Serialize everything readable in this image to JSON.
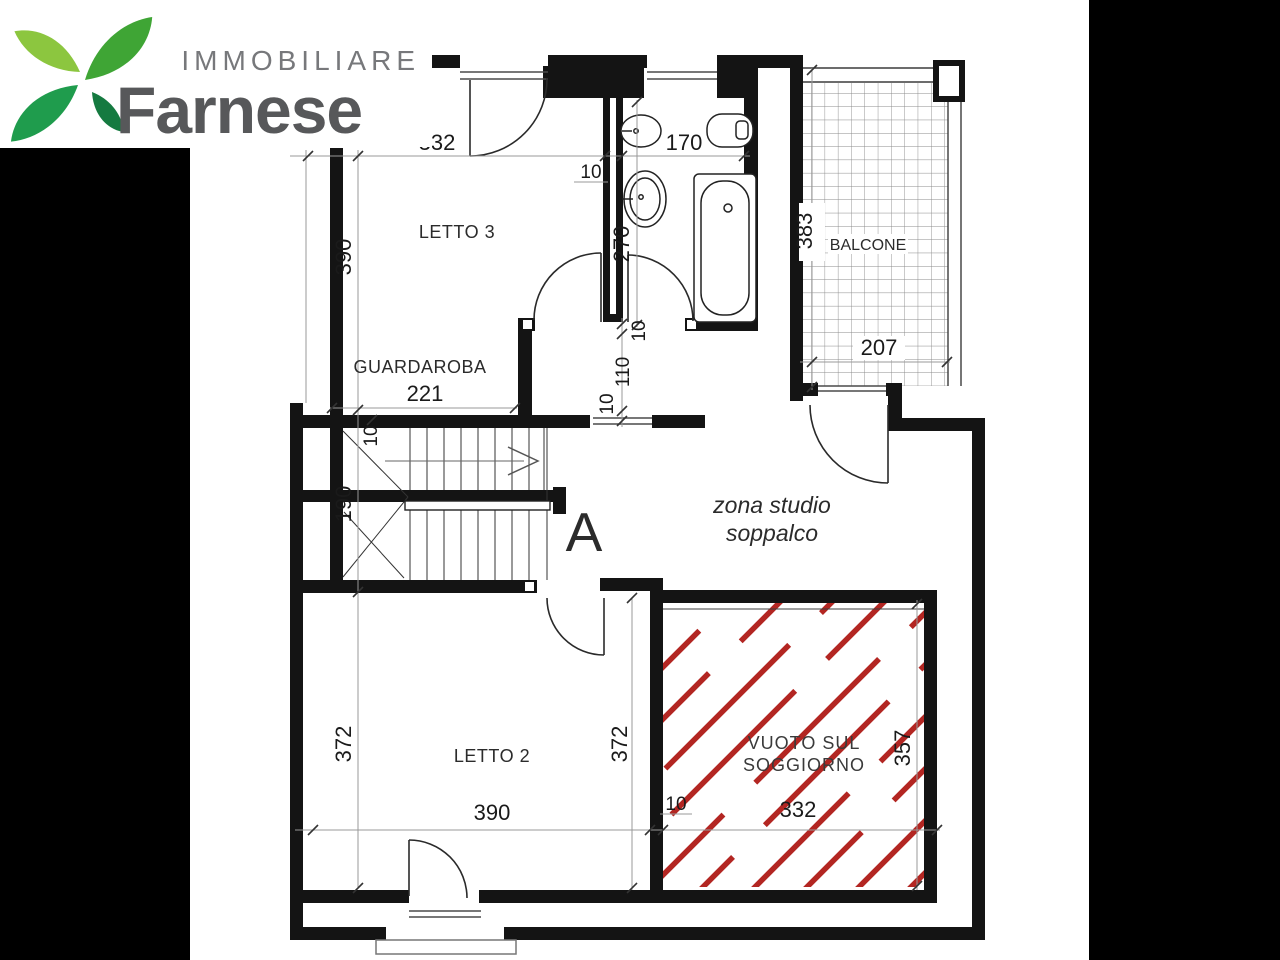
{
  "logo": {
    "brand_top": "IMMOBILIARE",
    "brand_name": "Farnese",
    "colors": {
      "immobiliare_text": "#77787B",
      "farnese_text": "#57585A",
      "leaf_light": "#8CC63F",
      "leaf_green": "#3FA535",
      "leaf_mid": "#1F9C4D",
      "leaf_dark": "#157A40"
    }
  },
  "plan": {
    "labels": {
      "letto3": "LETTO 3",
      "guardaroba": "GUARDAROBA",
      "balcone": "BALCONE",
      "letto2": "LETTO 2",
      "zona_studio_1": "zona studio",
      "zona_studio_2": "soppalco",
      "vuoto_1": "VUOTO SUL",
      "vuoto_2": "SOGGIORNO",
      "section": "A"
    },
    "dims": {
      "letto3_width": "332",
      "bagno_width": "170",
      "wall_top": "10",
      "letto3_height": "390",
      "bagno_depth": "270",
      "balcone_height": "383",
      "balcone_width": "207",
      "guardaroba_width": "221",
      "wall_mid": "10",
      "passage": "110",
      "wall_low": "10",
      "stair_wall": "10",
      "stair_landing": "190",
      "letto2_height_left": "372",
      "letto2_height_right": "372",
      "letto2_width": "390",
      "wall_bottom": "10",
      "vuoto_width": "332",
      "vuoto_height": "357"
    },
    "colors": {
      "wall": "#141414",
      "hatch_red": "#B32622",
      "dim_line": "#999999",
      "dim_text": "#1A1A1A",
      "label_text": "#2B2B2B",
      "thin_line": "#3C3C3C",
      "tile_line": "#8A8A8A",
      "side_bars": "#000000"
    }
  }
}
